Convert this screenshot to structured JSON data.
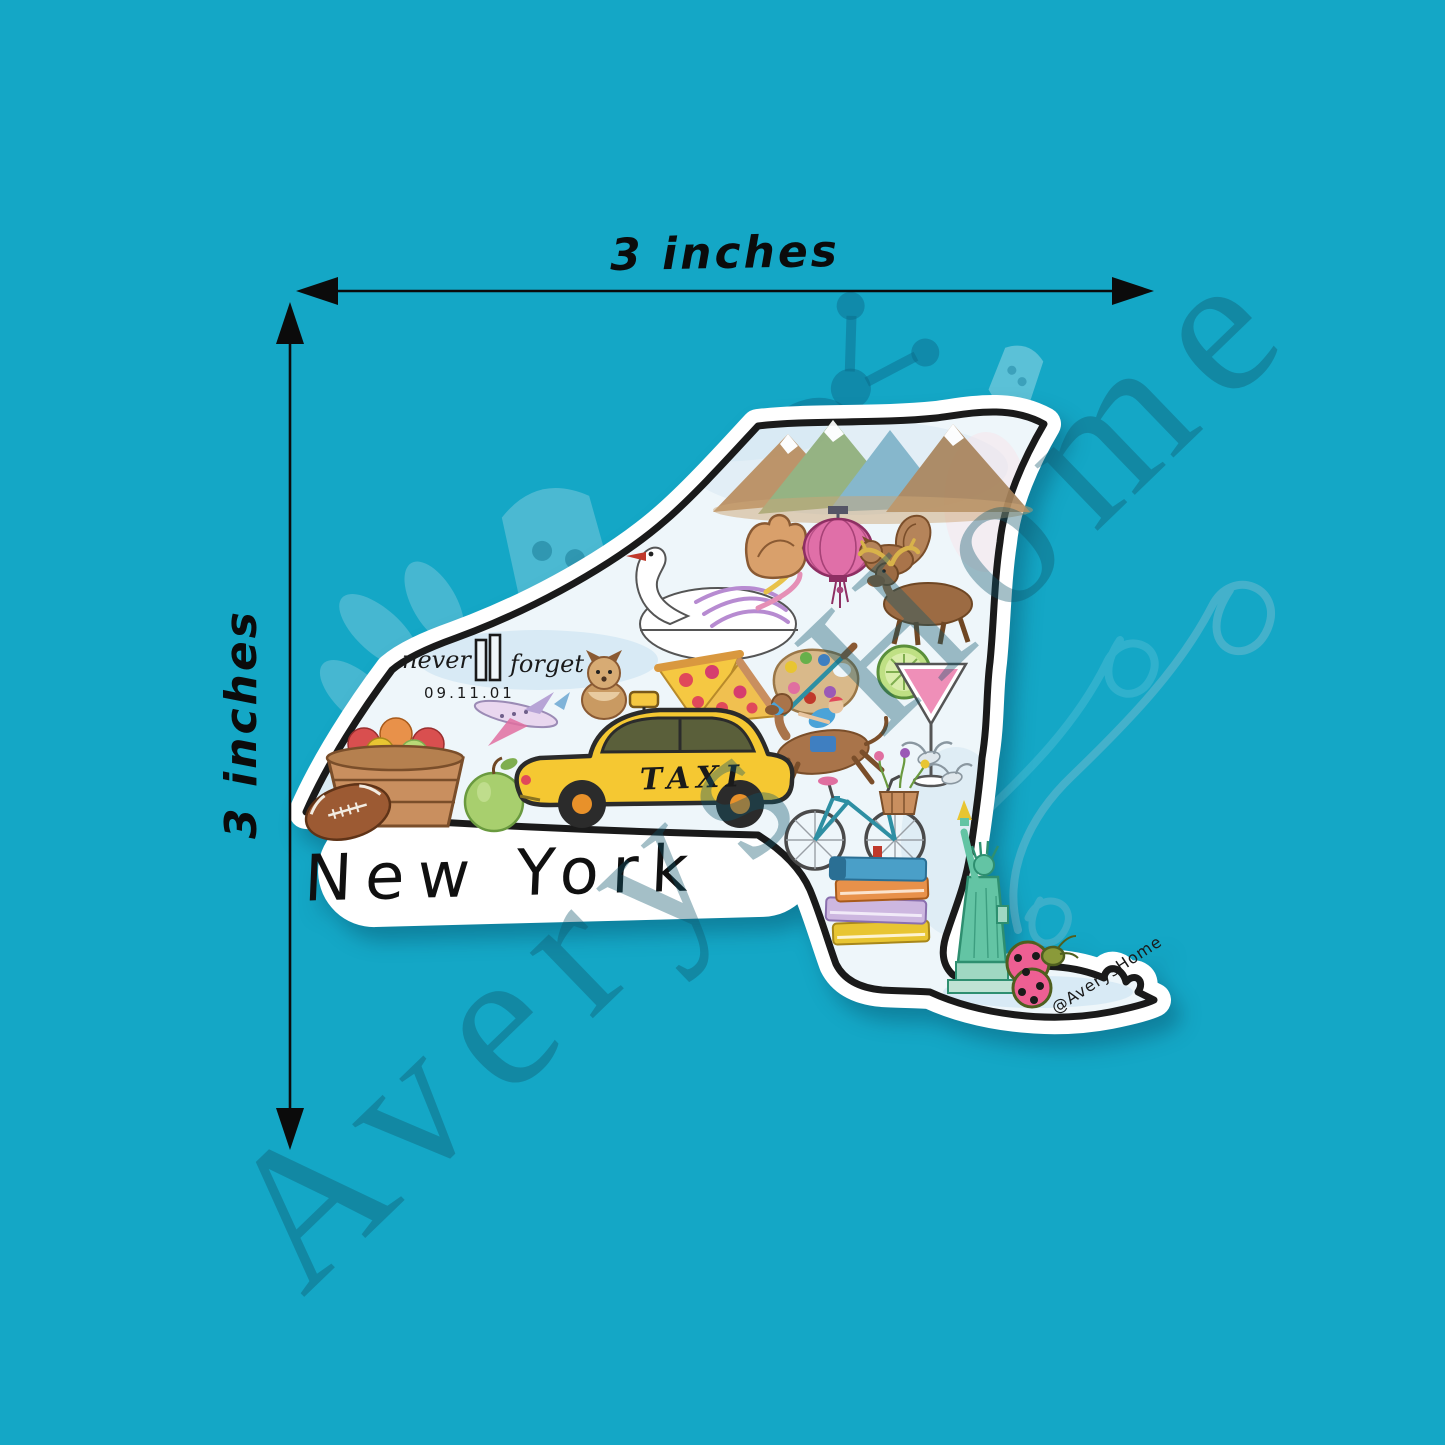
{
  "page": {
    "type": "sticker product mockup",
    "background_color": "#14a7c6"
  },
  "watermark": {
    "brand": "Averys Home",
    "logo": "ladybug-logo",
    "text_color": "#10566c"
  },
  "dimension_annotations": {
    "width_label": "3 inches",
    "height_label": "3 inches",
    "arrow_color": "#0b0b0b"
  },
  "sticker": {
    "title": "New York",
    "credit_handle": "@AverysHome",
    "taxi_text": "TAXI",
    "memorial": {
      "left": "never",
      "right": "forget",
      "date": "09.11.01"
    },
    "colors": {
      "die_cut_white": "#ffffff",
      "map_fill": "#eef6fa",
      "outline": "#1a1a1a",
      "taxi_yellow": "#f5c832",
      "lantern_pink": "#e85f9e",
      "liberty_green": "#57bd9a",
      "ladybug_pink": "#ee5f93"
    },
    "icons": [
      "adirondack-mountains",
      "swan",
      "baseball-glove",
      "paper-lantern",
      "squirrel",
      "moose",
      "yorkie-dog",
      "pizza-slices",
      "paint-palette",
      "lime-wheel",
      "cosmopolitan-cocktail",
      "racehorse-with-jockey",
      "doves",
      "airplane",
      "apple-basket",
      "green-apple",
      "football",
      "yellow-taxi",
      "bicycle-with-flower-basket",
      "book-stack",
      "statue-of-liberty",
      "ladybug"
    ]
  }
}
